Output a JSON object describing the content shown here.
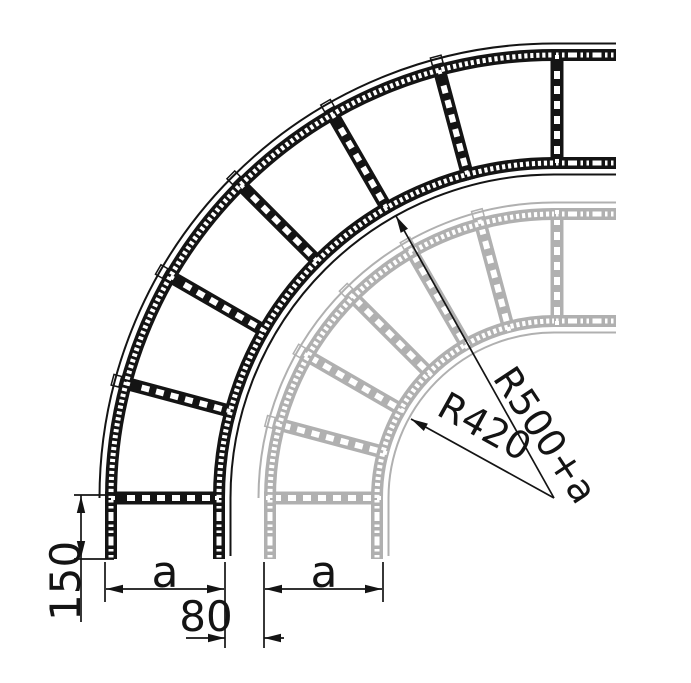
{
  "drawing": {
    "type": "cable-ladder-90-degree-bend-technical-drawing",
    "labels": {
      "radius_outer": "R500+a",
      "radius_inner": "R420",
      "tangent_length": "150",
      "gap": "80",
      "width_dark": "a",
      "width_gray": "a"
    },
    "colors": {
      "dark_ladder": "#141414",
      "gray_ladder": "#b0b0b0",
      "dimension": "#141414",
      "background": "#ffffff"
    }
  }
}
